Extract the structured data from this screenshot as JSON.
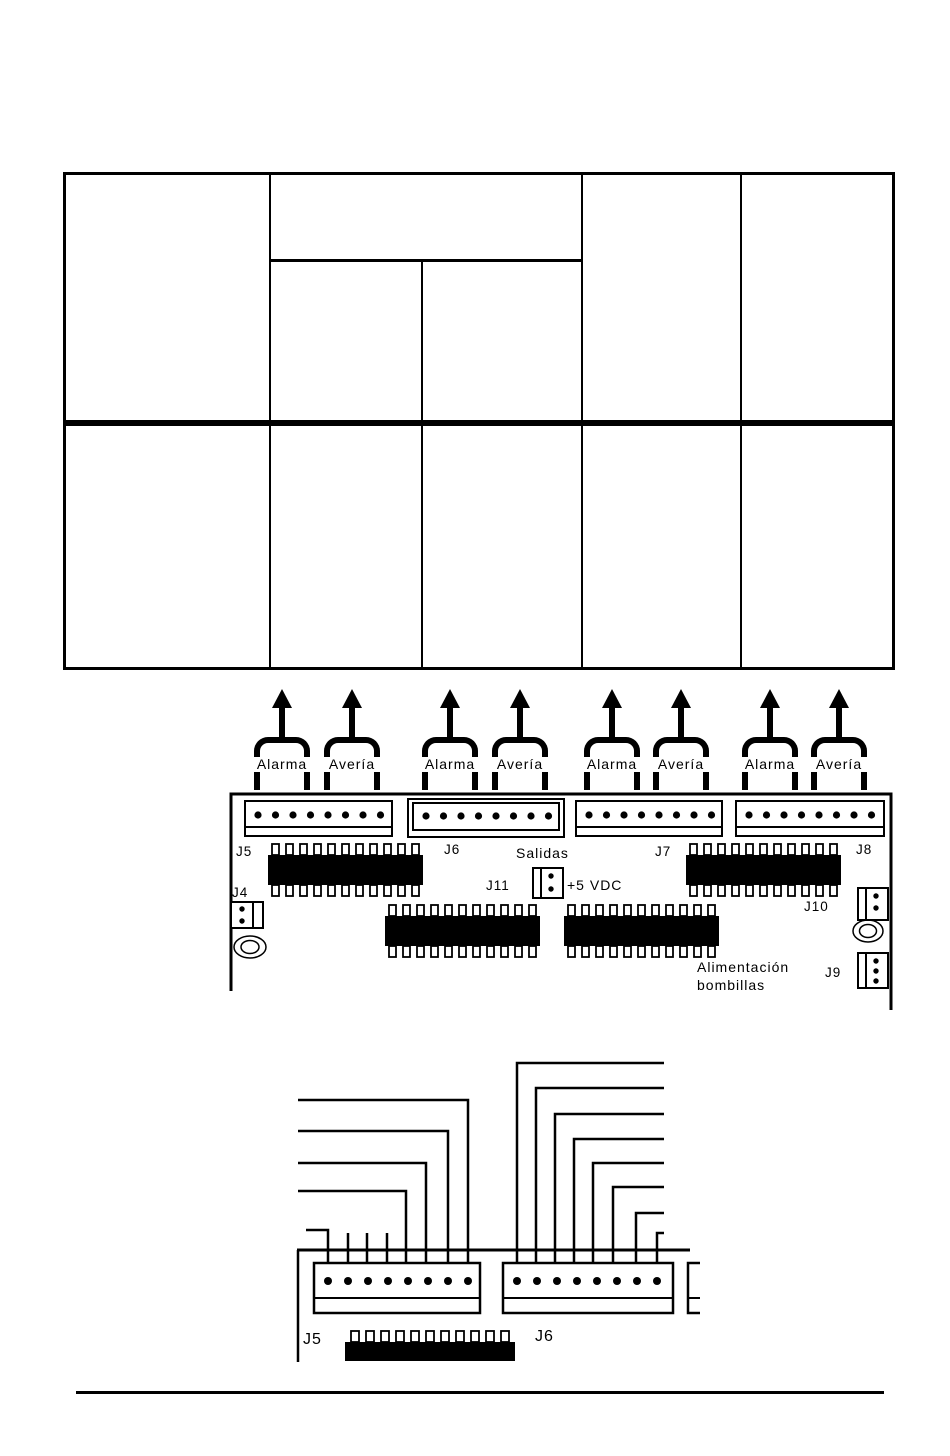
{
  "page": {
    "background": "#ffffff",
    "ink": "#000000"
  },
  "table": {
    "rows": 2,
    "columns": 5,
    "cells_empty": true
  },
  "figure1": {
    "arrow_groups": [
      {
        "label": "Alarma"
      },
      {
        "label": "Avería"
      },
      {
        "label": "Alarma"
      },
      {
        "label": "Avería"
      },
      {
        "label": "Alarma"
      },
      {
        "label": "Avería"
      },
      {
        "label": "Alarma"
      },
      {
        "label": "Avería"
      }
    ],
    "board": {
      "connector_labels": [
        "J5",
        "J6",
        "J7",
        "J8"
      ],
      "salidas_label": "Salidas",
      "j11_label": "J11",
      "power_label": "+5 VDC",
      "j4_label": "J4",
      "j10_label": "J10",
      "j9_label": "J9",
      "alimentacion_line1": "Alimentación",
      "alimentacion_line2": "bombillas"
    }
  },
  "figure2": {
    "j5_label": "J5",
    "j6_label": "J6"
  }
}
